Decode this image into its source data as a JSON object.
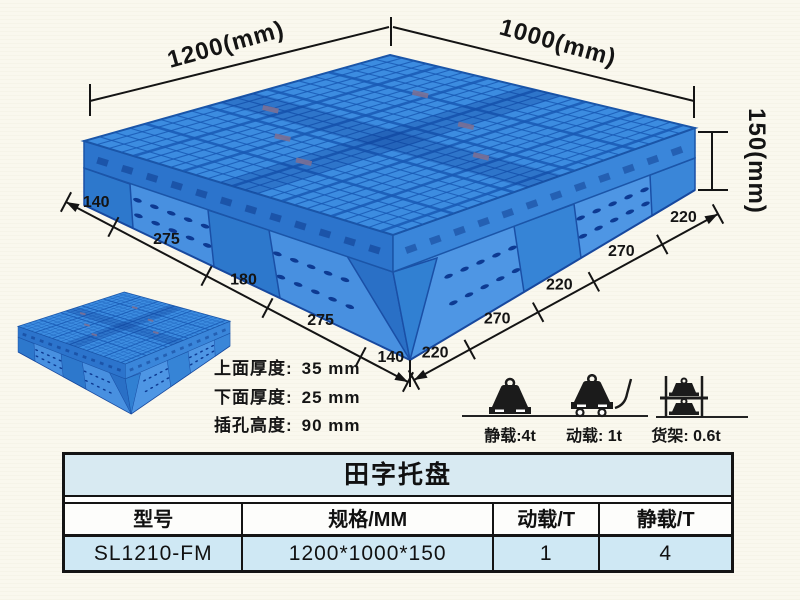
{
  "diagram": {
    "dim_width_left": "1200(mm)",
    "dim_width_right": "1000(mm)",
    "dim_height": "150(mm)",
    "left_edge_dims": [
      "140",
      "275",
      "180",
      "275",
      "140"
    ],
    "right_edge_dims": [
      "220",
      "270",
      "220",
      "270",
      "220"
    ],
    "notes": [
      {
        "label": "上面厚度:",
        "value": "35 mm"
      },
      {
        "label": "下面厚度:",
        "value": "25 mm"
      },
      {
        "label": "插孔高度:",
        "value": "90 mm"
      }
    ],
    "load_ratings": [
      {
        "icon": "static-load-icon",
        "label": "静载:4t"
      },
      {
        "icon": "dynamic-load-icon",
        "label": "动载: 1t"
      },
      {
        "icon": "rack-load-icon",
        "label": "货架: 0.6t"
      }
    ]
  },
  "table": {
    "title": "田字托盘",
    "headers": [
      "型号",
      "规格/MM",
      "动载/T",
      "静载/T"
    ],
    "rows": [
      [
        "SL1210-FM",
        "1200*1000*150",
        "1",
        "4"
      ]
    ]
  },
  "colors": {
    "pallet_blue": "#2f7dd8",
    "pallet_light_blue": "#4a97e8",
    "pallet_dark_blue": "#0d3a92",
    "table_title_bg": "#d8eaf2",
    "table_row_bg": "#cfe8f4",
    "dim_line": "#141414"
  }
}
